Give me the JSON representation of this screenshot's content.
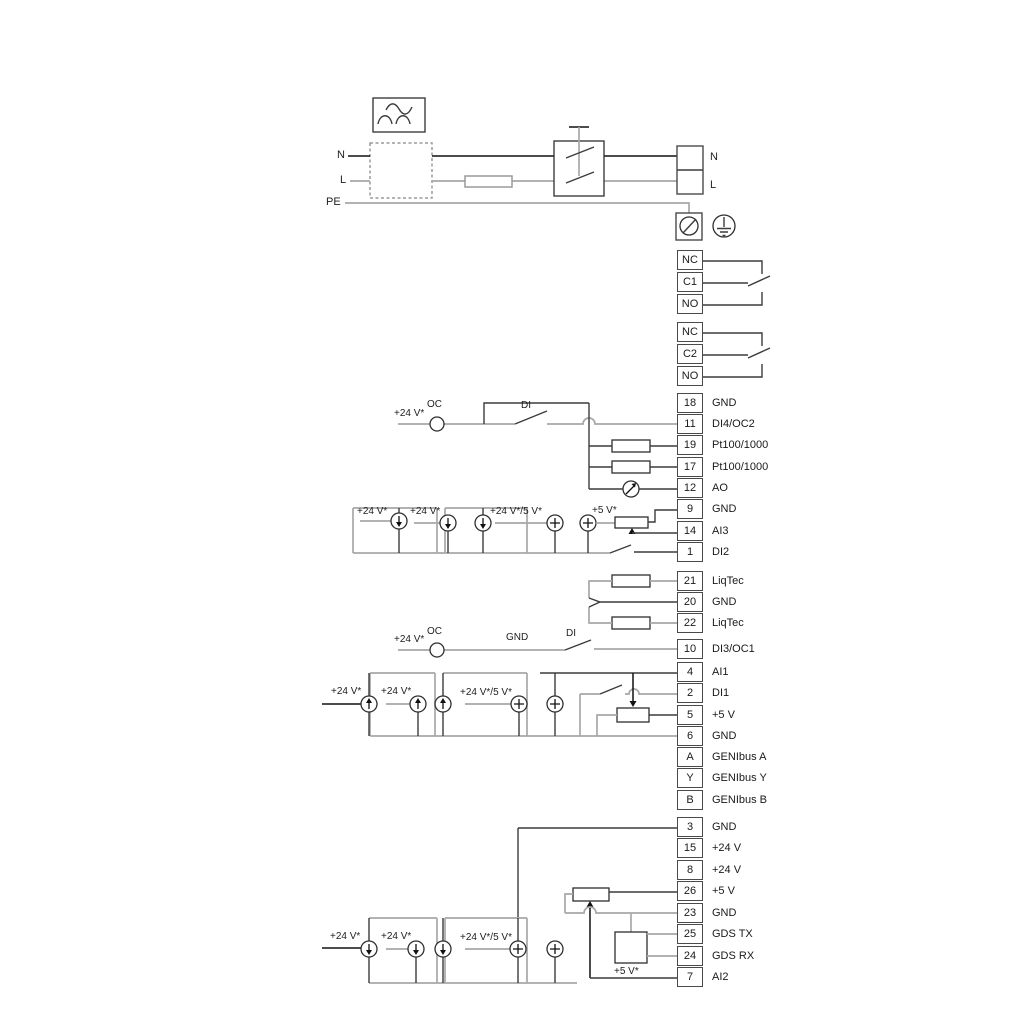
{
  "power": {
    "n": "N",
    "l": "L",
    "pe": "PE",
    "n_right": "N",
    "l_right": "L"
  },
  "relays": [
    {
      "rows": [
        "NC",
        "C1",
        "NO"
      ]
    },
    {
      "rows": [
        "NC",
        "C2",
        "NO"
      ]
    }
  ],
  "terminals": [
    {
      "num": "18",
      "label": "GND"
    },
    {
      "num": "11",
      "label": "DI4/OC2"
    },
    {
      "num": "19",
      "label": "Pt100/1000"
    },
    {
      "num": "17",
      "label": "Pt100/1000"
    },
    {
      "num": "12",
      "label": "AO"
    },
    {
      "num": "9",
      "label": "GND"
    },
    {
      "num": "14",
      "label": "AI3"
    },
    {
      "num": "1",
      "label": "DI2"
    },
    {
      "num": "21",
      "label": "LiqTec"
    },
    {
      "num": "20",
      "label": "GND"
    },
    {
      "num": "22",
      "label": "LiqTec"
    },
    {
      "num": "10",
      "label": "DI3/OC1"
    },
    {
      "num": "4",
      "label": "AI1"
    },
    {
      "num": "2",
      "label": "DI1"
    },
    {
      "num": "5",
      "label": "+5 V"
    },
    {
      "num": "6",
      "label": "GND"
    },
    {
      "num": "A",
      "label": "GENIbus A"
    },
    {
      "num": "Y",
      "label": "GENIbus Y"
    },
    {
      "num": "B",
      "label": "GENIbus B"
    },
    {
      "num": "3",
      "label": "GND"
    },
    {
      "num": "15",
      "label": "+24 V"
    },
    {
      "num": "8",
      "label": "+24 V"
    },
    {
      "num": "26",
      "label": "+5 V"
    },
    {
      "num": "23",
      "label": "GND"
    },
    {
      "num": "25",
      "label": "GDS TX"
    },
    {
      "num": "24",
      "label": "GDS RX"
    },
    {
      "num": "7",
      "label": "AI2"
    }
  ],
  "ann": {
    "di4": {
      "p24": "+24 V*",
      "oc": "OC",
      "di": "DI"
    },
    "ai3": {
      "p24a": "+24 V*",
      "p24b": "+24 V*",
      "p245": "+24 V*/5 V*",
      "p5": "+5 V*"
    },
    "di3": {
      "p24": "+24 V*",
      "oc": "OC",
      "gnd": "GND",
      "di": "DI"
    },
    "ai1": {
      "p24a": "+24 V*",
      "p24b": "+24 V*",
      "p245": "+24 V*/5 V*"
    },
    "ai2": {
      "p24a": "+24 V*",
      "p24b": "+24 V*",
      "p245": "+24 V*/5 V*",
      "p5": "+5 V*"
    }
  },
  "colors": {
    "wire_gray": "#a8a8a8",
    "wire_dark": "#3c3c3c",
    "wire_black": "#111111",
    "border": "#4a4a4a"
  }
}
